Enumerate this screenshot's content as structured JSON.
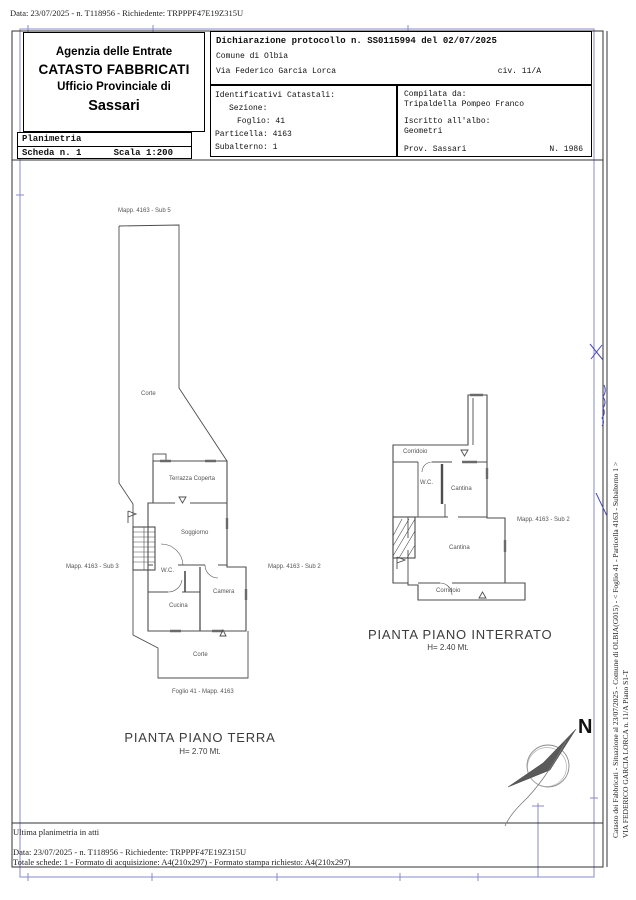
{
  "page": {
    "top_line": "Data: 23/07/2025 - n. T118956 - Richiedente: TRPPPF47E19Z315U",
    "bottom": {
      "line1": "Ultima planimetria in atti",
      "line2": "Data: 23/07/2025 - n. T118956 - Richiedente: TRPPPF47E19Z315U",
      "line3": "Totale schede: 1 - Formato di acquisizione: A4(210x297)  - Formato stampa richiesto: A4(210x297)"
    },
    "side_text": {
      "line1": "Catasto dei Fabbricati - Situazione al 23/07/2025 - Comune di OLBIA(G015) - <  Foglio 41 - Particella  4163 - Subalterno 1 >",
      "line2": "VIA FEDERICO GARCIA LORCA n. 11/A Piano S1-T"
    }
  },
  "header": {
    "agency": {
      "line1": "Agenzia delle Entrate",
      "line2": "CATASTO FABBRICATI",
      "line3": "Ufficio Provinciale di",
      "line4": "Sassari"
    },
    "planimetria": {
      "title": "Planimetria",
      "scheda": "Scheda n. 1",
      "scala": "Scala 1:200"
    },
    "declaration": {
      "protocol": "Dichiarazione protocollo n. SS0115994 del 02/07/2025",
      "comune": "Comune di Olbia",
      "street": "Via Federico Garcia Lorca",
      "civic": "civ. 11/A"
    },
    "identifiers": {
      "title": "Identificativi Catastali:",
      "sezione": "Sezione:",
      "foglio": "Foglio: 41",
      "particella": "Particella: 4163",
      "subalterno": "Subalterno: 1"
    },
    "compiler": {
      "label": "Compilata da:",
      "name": "Tripaldella Pompeo Franco",
      "albo_label": "Iscritto all'albo:",
      "albo": "Geometri",
      "prov": "Prov. Sassari",
      "number": "N. 1986"
    }
  },
  "ground_floor": {
    "sub5": "Mapp. 4163 - Sub 5",
    "corte_upper": "Corte",
    "terrazza": "Terrazza Coperta",
    "soggiorno": "Soggiorno",
    "wc": "W.C.",
    "cucina": "Cucina",
    "camera": "Camera",
    "sub3": "Mapp. 4163 - Sub 3",
    "sub2": "Mapp. 4163 - Sub 2",
    "corte_lower": "Corte",
    "foglio": "Foglio 41 - Mapp. 4163",
    "title": "PIANTA PIANO TERRA",
    "height": "H= 2.70 Mt."
  },
  "basement": {
    "corridoio_top": "Corridoio",
    "wc": "W.C.",
    "cantina_upper": "Cantina",
    "cantina_lower": "Cantina",
    "corridoio_bottom": "Corridoio",
    "sub2": "Mapp. 4163 - Sub 2",
    "title": "PIANTA PIANO INTERRATO",
    "height": "H= 2.40 Mt."
  },
  "compass": {
    "north": "N"
  },
  "colors": {
    "frame_blue": "#8a8ac8",
    "plan_ink": "#4d4d4d",
    "signature_blue": "#4646c8"
  }
}
